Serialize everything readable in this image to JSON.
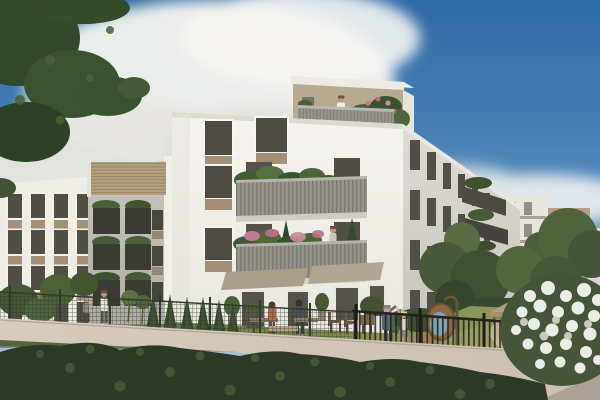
{
  "image": {
    "kind": "architectural-rendering",
    "subject": "Modern white apartment complex with planted balconies and a shared residential garden",
    "time_of_day": "daytime",
    "people_count": 9,
    "animal_count": 1
  },
  "palette": {
    "sky_top": "#2d6aa6",
    "sky_mid": "#4f86ba",
    "sky_low": "#86abcd",
    "sky_horizon": "#bccfdb",
    "cloud_white": "#f3f2ee",
    "cloud_gray": "#dcdbd6",
    "facade_sunlit": "#f5f4f0",
    "facade_bottom": "#e9e7e1",
    "facade_left": "#efede8",
    "facade_mid_gray": "#c0bdb6",
    "wing_top": "#dedcd7",
    "wing_bottom": "#c7c4bd",
    "panel_tan": "#a29076",
    "window_glass": "#4f4c46",
    "window_frame": "#f6f5f1",
    "railing_gray": "#96948d",
    "balcony_dark": "#3b3b36",
    "penthouse_wall": "#b7aa93",
    "roof_slats": "#b2a082",
    "foliage_dark": "#32482a",
    "foliage_mid": "#4c5f38",
    "foliage_light": "#5d7243",
    "flower_pink": "#c07e95",
    "flower_white": "#ecece6",
    "grass_sun": "#9aa05f",
    "grass_shade": "#5f6f45",
    "hedge_dark": "#2e3827",
    "path_light": "#d6ccbc",
    "fence_dark": "#26241f",
    "wood_tan": "#b3a07b",
    "lounger_tan": "#cdbb97",
    "cushion_blue": "#7fa6b4",
    "skin": "#c29a7e"
  },
  "scene": {
    "style": "photorealistic exterior visualization",
    "sky": "blue sky with large cumulus clouds on the left and near the right horizon",
    "buildings": [
      {
        "name": "left-building",
        "floors": 4,
        "facade": "white with tan panels under windows",
        "roof_feature": "timber slat screen on roof"
      },
      {
        "name": "mid-building",
        "facade": "gray-white with dark planted balconies"
      },
      {
        "name": "main-building",
        "floors": 5,
        "facade": "white with tan panels and gray slatted balconies overflowing with plants",
        "penthouse_terrace": "set-back top floor with railing, plants and a resident"
      },
      {
        "name": "right-wing",
        "facade": "shaded white, tall dark windows, small planted balconies"
      },
      {
        "name": "background-buildings",
        "facade": "white and tan blocks behind trees"
      }
    ],
    "garden": {
      "features": [
        "lawn",
        "row of cypress trees",
        "hanging egg chair with blue cushion",
        "two sun loungers",
        "tan gazebo canopy",
        "benches with low table",
        "outdoor chairs",
        "awnings over ground-floor terraces",
        "black picket fence",
        "wire mesh fence",
        "foreground hedge",
        "white flowering shrub",
        "light paved path"
      ]
    },
    "people": [
      {
        "where": "penthouse terrace",
        "doing": "standing at railing"
      },
      {
        "where": "second-floor balcony",
        "doing": "standing"
      },
      {
        "where": "left yard",
        "doing": "two residents walking"
      },
      {
        "where": "garden benches",
        "doing": "couple sitting and talking"
      },
      {
        "where": "lawn",
        "doing": "adult and child dancing"
      },
      {
        "where": "sun lounger",
        "doing": "woman sitting"
      }
    ],
    "animals": [
      {
        "type": "dog",
        "where": "lawn near the egg chair"
      }
    ],
    "foreground": "dark clipped hedge and low wall along a walkway; leafy tree branches overhang the top-left corner"
  }
}
